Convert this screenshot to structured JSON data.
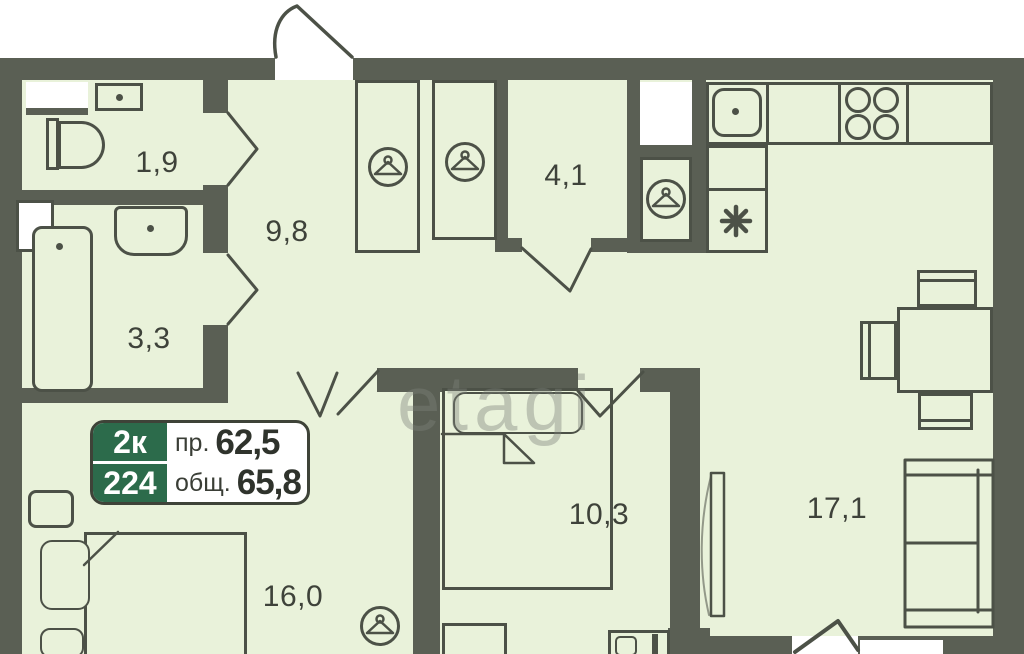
{
  "plan": {
    "type": "apartment-floor-plan",
    "watermark": "etagi",
    "badge": {
      "rooms": "2к",
      "unit": "224",
      "living_label": "пр.",
      "living_value": "62,5",
      "total_label": "общ.",
      "total_value": "65,8"
    },
    "rooms": [
      {
        "name": "wc",
        "area": "1,9"
      },
      {
        "name": "hallway",
        "area": "9,8"
      },
      {
        "name": "bathroom",
        "area": "3,3"
      },
      {
        "name": "wardrobe-room",
        "area": "4,1"
      },
      {
        "name": "bedroom-small",
        "area": "10,3"
      },
      {
        "name": "bedroom-large",
        "area": "16,0"
      },
      {
        "name": "living-kitchen",
        "area": "17,1"
      }
    ],
    "icons": [
      "hanger-icon",
      "hanger-icon",
      "hanger-icon",
      "hanger-icon",
      "snowflake-icon",
      "stove-burners-icon",
      "sink-icon"
    ],
    "colors": {
      "wall": "#5a5f54",
      "floor": "#e9f2da",
      "line": "#4c5147",
      "badge_green": "#2c6b4b",
      "white": "#ffffff"
    }
  }
}
